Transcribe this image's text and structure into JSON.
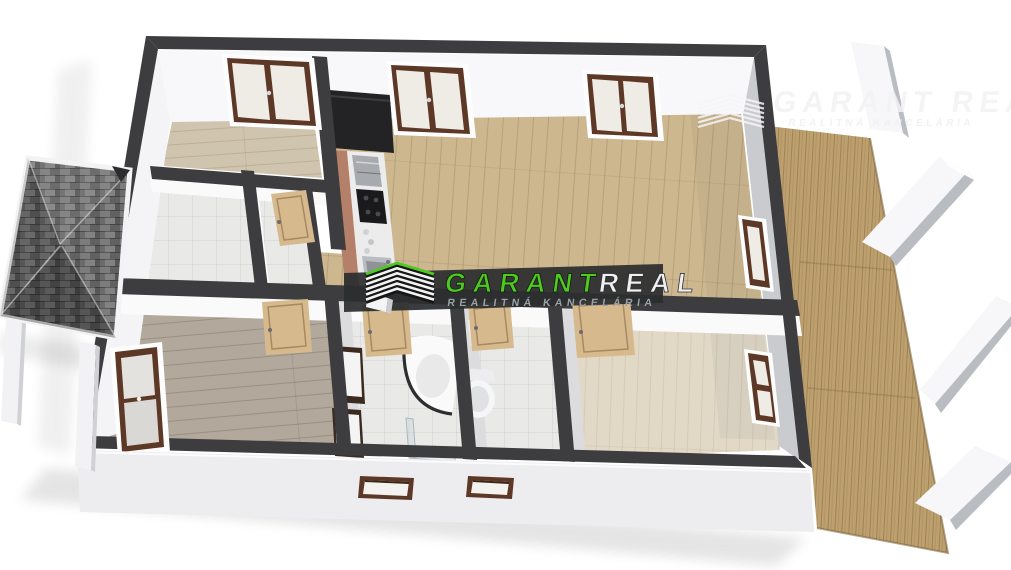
{
  "page": {
    "background": "#ffffff",
    "description": "3D axonometric doll-house rendering of an apartment floor plan, watermarked by a real-estate agency"
  },
  "branding": {
    "center_watermark": {
      "logo": "roof-chevrons-icon",
      "title_primary": "GARANT",
      "title_secondary": "REAL",
      "tagline": "REALITNÁ KANCELÁRIA"
    },
    "corner_watermark": {
      "title": "GARANT REAL",
      "tagline": "REALITNÁ KANCELÁRIA"
    }
  },
  "palette": {
    "wall_dark": "#3d3d3f",
    "face_light": "#f7f7f9",
    "face_shade": "#c9cbce",
    "facade": "#ededf0",
    "floor_living": "#cdb78f",
    "floor_room1": "#cfc4ae",
    "floor_bed2": "#b2a89b",
    "floor_bed3": "#e1d8c6",
    "floor_tile": "#e9e9e7",
    "deck": "#bda06e",
    "roof_base": "#6b6b6b",
    "terracotta": "#b5806a",
    "door_oak": "#d6ba8d",
    "window_frame": "#5e3826",
    "glass": "#efece6",
    "counter": "#ececec",
    "stainless": "#a7abb0",
    "unit_dark": "#232326",
    "green": "#4fc824",
    "band": "#2b2d2f",
    "subtitle_grey": "#9aa0a5"
  },
  "scene": {
    "view": "top-down 3D cutaway floor plan",
    "rooms": [
      "bedroom top-left with double window",
      "entrance hall",
      "storage / small room with open door",
      "open living room with kitchen strip",
      "bedroom bottom-left",
      "bathroom with corner tub, double vanity and shower",
      "separate wc",
      "bedroom bottom-right"
    ],
    "exterior": [
      "grey shingle entrance canopy with white posts (left)",
      "wooden terrace deck with white partition wall stubs (right)",
      "white facade with two small windows (bottom)"
    ],
    "fixtures": [
      "kitchen tall dark unit, fridge, cooktop, sink",
      "corner bathtub",
      "shower enclosure",
      "two vanity basins",
      "toilet",
      "small washbasin"
    ],
    "openings": {
      "windows": 7,
      "doors": 6
    }
  }
}
